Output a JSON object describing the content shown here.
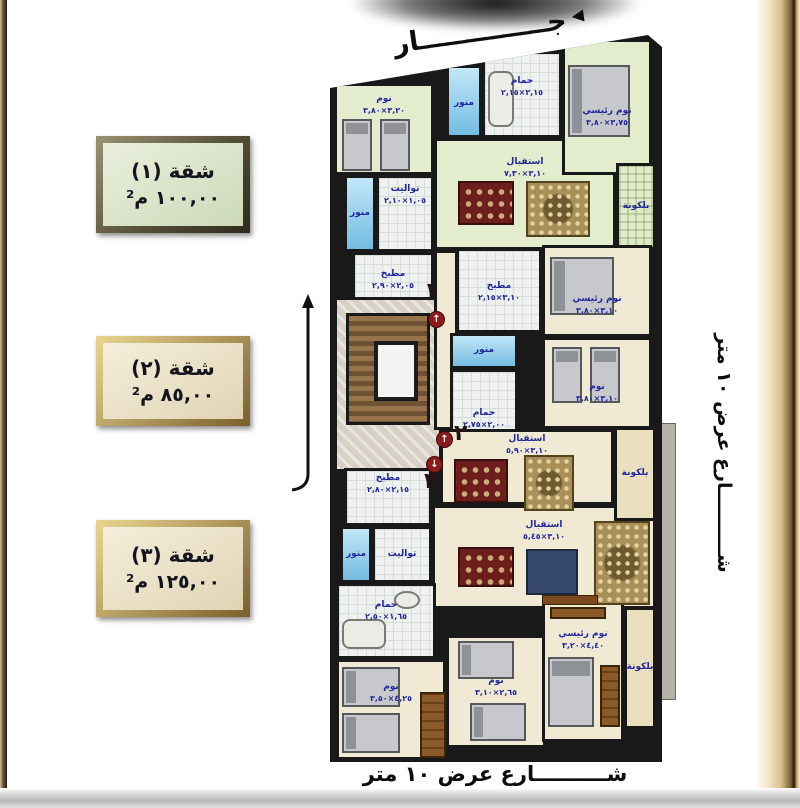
{
  "colors": {
    "wall": "#191919",
    "green": "#e3edcd",
    "cream": "#f0e9d4",
    "cream2": "#eadfbf",
    "tilebg": "#eef1ef",
    "blue1": "#c2e7f8",
    "blue2": "#74bce2",
    "labeltext": "#23269b",
    "marker": "#8e1b1b"
  },
  "legend": {
    "apartments": [
      {
        "title": "شقة (١)",
        "area": "١٠٠,٠٠ م²"
      },
      {
        "title": "شقة (٢)",
        "area": "٨٥,٠٠ م²"
      },
      {
        "title": "شقة (٣)",
        "area": "١٢٥,٠٠ م²"
      }
    ]
  },
  "annotations": {
    "neighbor_top": "جــــــــــــــار",
    "street_right": "شــــــــــارع عرض ١٠ متر",
    "street_bottom": "شــــــــــارع عرض ١٠ متر"
  },
  "plan": {
    "rooms": [
      {
        "key": "apt1-reception",
        "label": "استقبال",
        "dims": "٣,١٠×٧,٣٠",
        "x": 104,
        "y": 103,
        "w": 182,
        "h": 112,
        "t": "green",
        "lp": 16
      },
      {
        "key": "apt1-bedroom",
        "label": "نوم",
        "dims": "٣,٢٠×٣,٨٠",
        "x": 4,
        "y": 48,
        "w": 100,
        "h": 92,
        "t": "green",
        "lp": 8
      },
      {
        "key": "apt1-toilet",
        "label": "توالیت",
        "dims": "١,٠٥×٢,١٠",
        "x": 46,
        "y": 140,
        "w": 58,
        "h": 77,
        "t": "tile",
        "lp": 6
      },
      {
        "key": "apt1-lightwell-1",
        "label": "منور",
        "x": 14,
        "y": 140,
        "w": 32,
        "h": 77,
        "t": "blue"
      },
      {
        "key": "apt1-kitchen",
        "label": "مطبخ",
        "dims": "٢,٠٥×٢,٩٠",
        "x": 22,
        "y": 217,
        "w": 82,
        "h": 80,
        "t": "tile",
        "lp": 14
      },
      {
        "key": "apt1-bathroom",
        "label": "حمام",
        "dims": "٢,١٥×٢,١٥",
        "x": 152,
        "y": 16,
        "w": 80,
        "h": 87,
        "t": "tile",
        "lp": 22
      },
      {
        "key": "apt1-lightwell-2",
        "label": "منور",
        "x": 116,
        "y": 30,
        "w": 36,
        "h": 73,
        "t": "blue",
        "lp": 30
      },
      {
        "key": "apt1-master-bedroom",
        "label": "نوم رئيسي",
        "dims": "٣,٧٥×٣,٨٠",
        "x": 232,
        "y": 4,
        "w": 90,
        "h": 136,
        "t": "green",
        "lp": 64
      },
      {
        "key": "apt1-balcony",
        "label": "بلكونة",
        "x": 286,
        "y": 128,
        "w": 40,
        "h": 87,
        "t": "plaid"
      },
      {
        "key": "entrance-lobby",
        "x": 4,
        "y": 262,
        "w": 108,
        "h": 175,
        "t": "marble"
      },
      {
        "key": "staircase",
        "x": 16,
        "y": 278,
        "w": 84,
        "h": 112,
        "t": "wood"
      },
      {
        "key": "apt2-hall",
        "x": 104,
        "y": 215,
        "w": 24,
        "h": 180,
        "t": "cream"
      },
      {
        "key": "apt2-kitchen",
        "label": "مطبخ",
        "dims": "٣,١٠×٢,١٥",
        "x": 126,
        "y": 213,
        "w": 86,
        "h": 85,
        "t": "tile",
        "lp": 30
      },
      {
        "key": "apt2-lightwell",
        "label": "منور",
        "x": 120,
        "y": 298,
        "w": 68,
        "h": 36,
        "t": "blue"
      },
      {
        "key": "apt2-bathroom",
        "label": "حمام",
        "dims": "٢,٠٠×٢,٧٥",
        "x": 120,
        "y": 334,
        "w": 68,
        "h": 74,
        "t": "tile",
        "lp": 36
      },
      {
        "key": "apt2-master-bedroom",
        "label": "نوم رئيسي",
        "dims": "٣,١٠×٣,٨٠",
        "x": 212,
        "y": 210,
        "w": 110,
        "h": 92,
        "t": "cream",
        "lp": 46
      },
      {
        "key": "apt2-bedroom",
        "label": "نوم",
        "dims": "٣,١٠×٣,٨٠",
        "x": 212,
        "y": 302,
        "w": 110,
        "h": 92,
        "t": "cream",
        "lp": 42
      },
      {
        "key": "apt2-reception",
        "label": "استقبال",
        "dims": "٣,١٠×٥,٩٠",
        "x": 110,
        "y": 394,
        "w": 174,
        "h": 76,
        "t": "cream",
        "lp": 2
      },
      {
        "key": "apt3-reception",
        "label": "استقبال",
        "dims": "٣,١٠×٥,٤٥",
        "x": 102,
        "y": 470,
        "w": 224,
        "h": 104,
        "t": "cream",
        "lp": 12
      },
      {
        "key": "apt2-balcony",
        "label": "بلكونة",
        "x": 284,
        "y": 392,
        "w": 42,
        "h": 94,
        "t": "cream2"
      },
      {
        "key": "apt3-kitchen",
        "label": "مطبخ",
        "dims": "٢,١٥×٢,٨٠",
        "x": 14,
        "y": 433,
        "w": 88,
        "h": 58,
        "t": "tile",
        "lp": 2
      },
      {
        "key": "apt3-lightwell",
        "label": "منور",
        "x": 10,
        "y": 491,
        "w": 32,
        "h": 57,
        "t": "blue"
      },
      {
        "key": "apt3-toilet",
        "label": "توالیت",
        "x": 42,
        "y": 491,
        "w": 60,
        "h": 57,
        "t": "tile"
      },
      {
        "key": "apt3-bathroom",
        "label": "حمام",
        "dims": "١,٦٥×٢,٥٠",
        "x": 6,
        "y": 548,
        "w": 100,
        "h": 76,
        "t": "tile",
        "lp": 14
      },
      {
        "key": "apt3-bedroom-1",
        "label": "نوم",
        "dims": "٤,٢٥×٣,٥٠",
        "x": 6,
        "y": 624,
        "w": 110,
        "h": 101,
        "t": "cream",
        "lp": 20
      },
      {
        "key": "apt3-bedroom-2",
        "label": "نوم",
        "dims": "٢,٦٥×٣,١٠",
        "x": 116,
        "y": 600,
        "w": 100,
        "h": 113,
        "t": "cream",
        "lp": 38
      },
      {
        "key": "apt3-master-bedroom",
        "label": "نوم رئيسي",
        "dims": "٤,٤٠×٣,٢٠",
        "x": 212,
        "y": 567,
        "w": 82,
        "h": 140,
        "t": "cream",
        "lp": 24
      },
      {
        "key": "apt3-balcony",
        "label": "بلكونة",
        "x": 294,
        "y": 572,
        "w": 32,
        "h": 122,
        "t": "cream2"
      }
    ],
    "furniture": [
      {
        "t": "bed-v",
        "x": 12,
        "y": 84,
        "w": 30,
        "h": 52
      },
      {
        "t": "bed-v",
        "x": 50,
        "y": 84,
        "w": 30,
        "h": 52
      },
      {
        "t": "tub-v",
        "x": 158,
        "y": 36,
        "w": 26,
        "h": 56
      },
      {
        "t": "bed-h",
        "x": 238,
        "y": 30,
        "w": 62,
        "h": 72
      },
      {
        "t": "dining",
        "x": 128,
        "y": 146,
        "w": 56,
        "h": 44
      },
      {
        "t": "sofa",
        "x": 196,
        "y": 146,
        "w": 64,
        "h": 56
      },
      {
        "t": "elev",
        "x": 44,
        "y": 306,
        "w": 44,
        "h": 60
      },
      {
        "t": "bed-h",
        "x": 220,
        "y": 222,
        "w": 64,
        "h": 58
      },
      {
        "t": "bed-v",
        "x": 222,
        "y": 312,
        "w": 30,
        "h": 56
      },
      {
        "t": "bed-v",
        "x": 260,
        "y": 312,
        "w": 30,
        "h": 56
      },
      {
        "t": "dining",
        "x": 124,
        "y": 424,
        "w": 54,
        "h": 44
      },
      {
        "t": "sofa",
        "x": 194,
        "y": 420,
        "w": 50,
        "h": 56
      },
      {
        "t": "dining",
        "x": 128,
        "y": 512,
        "w": 56,
        "h": 40
      },
      {
        "t": "tv",
        "x": 196,
        "y": 514,
        "w": 52,
        "h": 46
      },
      {
        "t": "sofa",
        "x": 264,
        "y": 486,
        "w": 56,
        "h": 84
      },
      {
        "t": "table",
        "x": 212,
        "y": 560,
        "w": 56,
        "h": 10
      },
      {
        "t": "tub-h",
        "x": 12,
        "y": 584,
        "w": 44,
        "h": 30
      },
      {
        "t": "sink",
        "x": 64,
        "y": 556,
        "w": 26,
        "h": 18
      },
      {
        "t": "bed-h",
        "x": 12,
        "y": 632,
        "w": 58,
        "h": 40
      },
      {
        "t": "bed-h",
        "x": 12,
        "y": 678,
        "w": 58,
        "h": 40
      },
      {
        "t": "wardrobe",
        "x": 90,
        "y": 657,
        "w": 26,
        "h": 66
      },
      {
        "t": "bed-h",
        "x": 128,
        "y": 606,
        "w": 56,
        "h": 38
      },
      {
        "t": "bed-h",
        "x": 140,
        "y": 668,
        "w": 56,
        "h": 38
      },
      {
        "t": "bed-v",
        "x": 218,
        "y": 622,
        "w": 46,
        "h": 70
      },
      {
        "t": "dresser",
        "x": 220,
        "y": 572,
        "w": 56,
        "h": 12
      },
      {
        "t": "wardrobe",
        "x": 270,
        "y": 630,
        "w": 20,
        "h": 62
      }
    ],
    "markers": [
      {
        "id": "1",
        "num": "١",
        "cx": 98,
        "cy": 276,
        "nx": 94,
        "ny": 246,
        "arrow": "↑"
      },
      {
        "id": "2",
        "num": "٢",
        "cx": 106,
        "cy": 396,
        "nx": 124,
        "ny": 388,
        "arrow": "↑"
      },
      {
        "id": "3",
        "num": "٣",
        "cx": 96,
        "cy": 421,
        "nx": 94,
        "ny": 436,
        "arrow": "↓"
      }
    ]
  }
}
